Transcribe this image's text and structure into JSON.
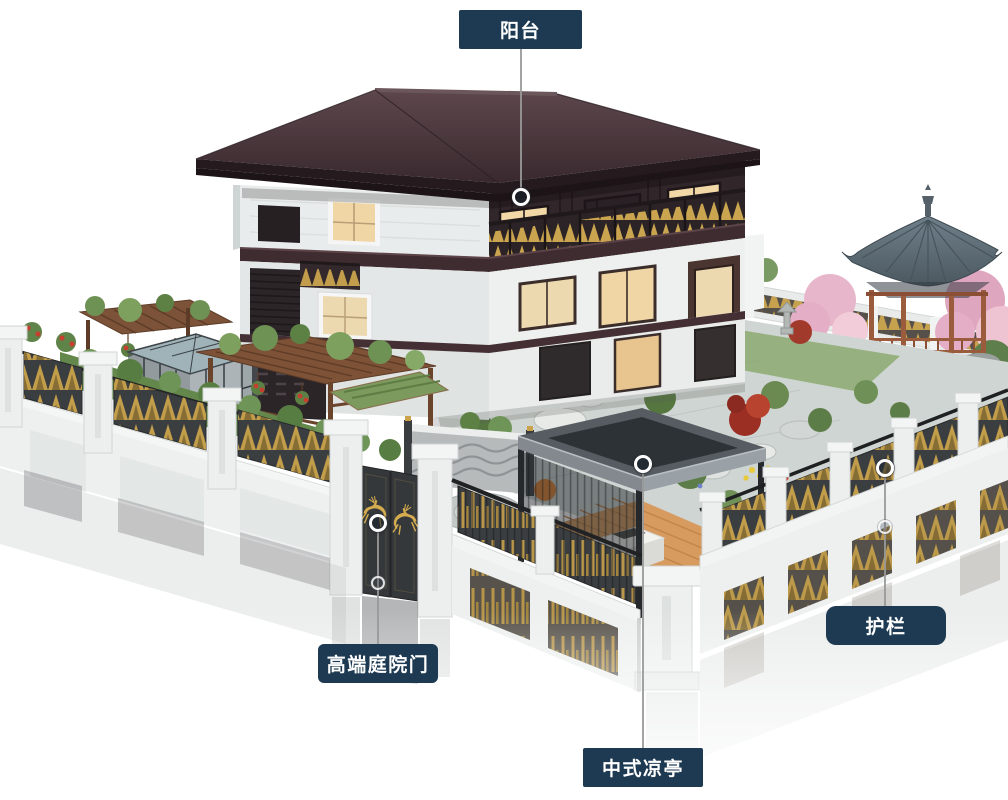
{
  "callouts": [
    {
      "id": "balcony",
      "label": "阳台"
    },
    {
      "id": "courtyard-gate",
      "label": "高端庭院门"
    },
    {
      "id": "chinese-pavilion",
      "label": "中式凉亭"
    },
    {
      "id": "guardrail",
      "label": "护栏"
    }
  ],
  "palette": {
    "background": "#ffffff",
    "callout_bg": "#1d3a52",
    "callout_text": "#ffffff",
    "connector_line": "#999999",
    "marker_ring": "#ffffff",
    "house_roof": "#46343a",
    "house_wood": "#31272b",
    "wall_white": "#eef0ef",
    "gold_accent": "#c9a24a",
    "gazebo_roof": "#5a6770",
    "gazebo_wood": "#9a5c3d",
    "pavilion_roof": "#2d3236",
    "fence_panel": "#3b3e41",
    "deck_wood": "#d79a5f",
    "foliage_green": "#6e9154",
    "maple_red": "#9c2f24",
    "orange_shrub": "#dd7a2e",
    "blossom_pink": "#e3aec6"
  }
}
